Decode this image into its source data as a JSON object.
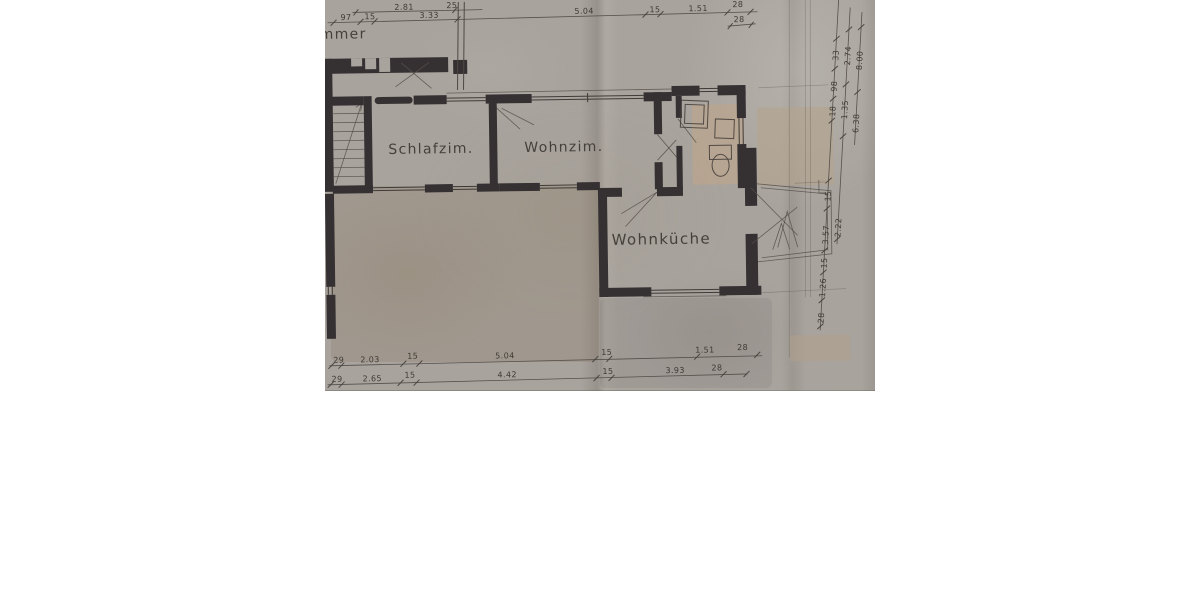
{
  "scan": {
    "description": "scanned architectural floor plan, upper storey",
    "paper_color": "#a8a39d",
    "wall_color": "#353032",
    "ink_color": "#4d4742",
    "patch_color": "#b9a58f",
    "background_color": "#ffffff"
  },
  "plan": {
    "rooms": {
      "partial": {
        "label": "mmer"
      },
      "schlafzimmer": {
        "label": "Schlafzim."
      },
      "wohnzimmer": {
        "label": "Wohnzim."
      },
      "wohnkueche": {
        "label": "Wohnküche"
      }
    },
    "dims": {
      "upper": [
        "2.81",
        "25"
      ],
      "top": [
        "97",
        "15",
        "3.33",
        "5.04",
        "15",
        "1.51",
        "28"
      ],
      "top_right": [
        "28"
      ],
      "bottom_a": [
        "29",
        "2.03",
        "15",
        "5.04",
        "15",
        "1.51",
        "28"
      ],
      "bottom_b": [
        "29",
        "2.65",
        "15",
        "4.42",
        "15",
        "3.93",
        "28"
      ],
      "right_inner": [
        "33",
        "98",
        "18",
        "15",
        "3.57",
        "15",
        "1.26",
        "28"
      ],
      "right_middle": [
        "2.74",
        "1.35",
        "2.22"
      ],
      "right_outer": [
        "8.00",
        "6.38"
      ]
    }
  }
}
